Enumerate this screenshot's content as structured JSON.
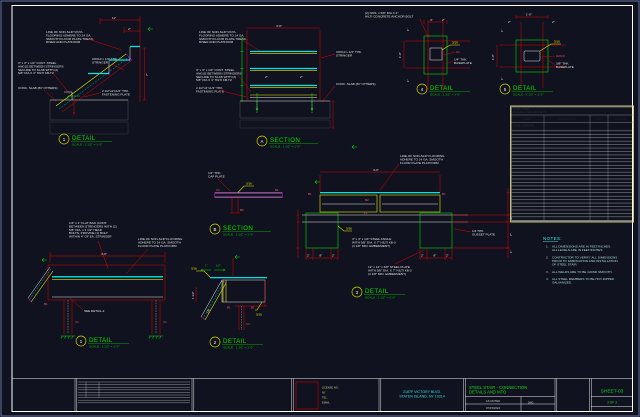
{
  "details": {
    "d1": {
      "title": {
        "num": "1",
        "kind": "DETAIL",
        "scale": "SCALE : 1 1/2\" = 1'-0\""
      },
      "labels": {
        "tread": [
          "LINE OF NON-SLIP VINYL",
          "FLOORING ADHERE TO 14 GA.",
          "SMOOTH FLOOR PLATE TREAD,",
          "RISER AND PLATFORM"
        ],
        "stringer": [
          "C8X10 x 1/4\" THK.",
          "STRINGER"
        ],
        "angle": [
          "3\" x 3\" x 1/4\" CONT. STEEL",
          "ANGLE BETWEEN STRINGERS",
          "SECURE TO SLAB WITH (2)",
          "5/8\" DIA X 4\" HILTI KB-TZ"
        ],
        "slab": "CONC. SLAB (BY OTHERS)",
        "plate": [
          "2 1/2\"x2\"x1/4\" THK.",
          "FASTENING PLATE"
        ]
      },
      "dims": {
        "a": "11\"",
        "b": "2\"",
        "c": "7\""
      }
    },
    "secA": {
      "title": {
        "num": "A",
        "kind": "SECTION",
        "scale": "SCALE : 1 1/2\" = 1'-0\""
      },
      "labels": {
        "tread": [
          "LINE OF NON-SLIP VINYL",
          "FLOORING ADHERE TO 14 GA.",
          "SMOOTH FLOOR PLATE TREAD,",
          "RISER AND PLATFORM"
        ],
        "angle": [
          "3\" x 3\" x 1/4\" CONT. STEEL",
          "ANGLE BETWEEN STRINGERS",
          "SECURE TO SLAB WITH (2)",
          "5/8\" DIA X 4\" HILTI KB-TZ"
        ],
        "plate": [
          "2 1/2\"x2\"x1/4\" THK.",
          "FASTENING PLATE"
        ],
        "stringer": [
          "C8X10 x 1/4\" THK.",
          "STRINGER"
        ],
        "slab": "CONC. SLAB (BY OTHERS)"
      },
      "dims": {
        "w": "4'-0\"",
        "a": "2\"",
        "b": "2\""
      }
    },
    "anchor_note": [
      "(2) NOS. x 5/8\" DIA X 4\"",
      "HILTI CONCRETE ANCHOR BOLT"
    ],
    "d4": {
      "title": {
        "num": "4",
        "kind": "DETAIL",
        "scale": "SCALE : 1 1/2\" = 1'-0\""
      },
      "labels": {
        "weld": "3/16",
        "mark": "C1",
        "plate": [
          "1/4\" THK.",
          "BASEPLATE"
        ]
      },
      "dims": {
        "a": "4\"",
        "b": "2\"",
        "h": "1'-0\"",
        "t1": "1\"",
        "t2": "1\""
      }
    },
    "d5": {
      "title": {
        "num": "5",
        "kind": "DETAIL",
        "scale": "SCALE : 1 1/2\" = 1'-0\""
      },
      "labels": {
        "weld": "3/16",
        "mark": "C2/C3",
        "plate": [
          "3/8\" THK.",
          "BASEPLATE"
        ]
      },
      "dims": {
        "w": "1'-0\"",
        "a": "2\"",
        "b": "2\"",
        "h": "1'-0\"",
        "t1": "1\"",
        "t2": "1\""
      }
    },
    "secB": {
      "title": {
        "num": "B",
        "kind": "SECTION",
        "scale": "SCALE : 1 1/2\" = 1'-0\""
      },
      "labels": {
        "cap": [
          "1/4\" THK.",
          "CAP PLATE"
        ],
        "weld": "3/16",
        "m1": "C1",
        "m2": "B1",
        "m3": "B2"
      }
    },
    "d3": {
      "title": {
        "num": "3",
        "kind": "DETAIL",
        "scale": "SCALE : 1 1/2\" = 1'-0\""
      },
      "labels": {
        "floor": [
          "LINE OF NON-SLIP FLOORING",
          "ADHERE TO 14 GA. SMOOTH",
          "FLOOR PLATE PLATFORM"
        ],
        "angle": [
          "4\" x 4\" x 1/4\" STEEL ANGLE",
          "WITH 5/8\" DIA. X 7\" HILTI KB-3",
          "(4 1/8\" MIN. EMBEDMENT)"
        ],
        "plate": [
          "12\" x 12\" x 3/8\" STEEL PLATE",
          "WITH 5/8\" DIA. X 7\" HILTI KB-3",
          "(4 1/8\" MIN. EMBEDMENT)"
        ],
        "gusset": [
          "1/4 THK.",
          "GUSSET PLATE"
        ],
        "weld": "3/16",
        "m1": "B1",
        "m2": "B1",
        "m3": "B2",
        "m4": "L1"
      },
      "dims": {
        "w": "4'-0\"",
        "s1": "2\"",
        "s2": "8\"",
        "s3": "2\"",
        "s4": "2\"",
        "s5": "8\"",
        "s6": "2\"",
        "r1": "1\"",
        "r2": "7\"",
        "r3": "1\""
      }
    },
    "d1b": {
      "title": {
        "num": "1",
        "kind": "DETAIL",
        "scale": "SCALE : 1 1/2\" = 1'-0\""
      },
      "labels": {
        "flatbar": [
          "1/4\" x 4\" FLAT BAR (CONT.",
          "BETWEEN STRINGERS WITH (2)",
          "5/8\" DIA. x 1 1/2\" HEAD",
          "BOLTS. PROVIDE (1) BOLT",
          "WITHIN 4\" OF EA. STRINGER"
        ],
        "floor": [
          "LINE OF NON-SLIP FLOORING",
          "ADHERE TO 14 GA. SMOOTH",
          "FLOOR PLATE PLATFORM"
        ],
        "see": "SEE DETAIL-2",
        "m1": "B1",
        "m2": "C1",
        "m3": "C1"
      },
      "dims": {
        "w": "4'-0\""
      }
    },
    "d2": {
      "title": {
        "num": "2",
        "kind": "DETAIL",
        "scale": "SCALE : 1 1/2\" = 1'-0\""
      },
      "labels": {
        "weld1": "3/16",
        "weld2": "3/16",
        "m1": "B1",
        "m2": "B1",
        "m3": "C1",
        "m4": "C8"
      },
      "dims": {
        "a": "1\"",
        "b": "1/2\"",
        "c": "1 1/2\""
      }
    }
  },
  "table": {
    "title": [
      "STEEL STAIR",
      "MATERIAL TAKE OFF (MTO)"
    ],
    "headers": [
      "MARK",
      "DESCRIPTION",
      "QTY",
      "LENGTH"
    ],
    "section": "STEEL MEMBERS",
    "row_count": 27
  },
  "notes": {
    "heading": "NOTES:",
    "items": [
      {
        "no": "1.",
        "lines": [
          "ALL DIMENSIONS ARE IN FEET/INCHES.",
          "ALL LEVELS ARE IN FEET/INCHES."
        ]
      },
      {
        "no": "2.",
        "lines": [
          "CONTRACTOR TO VERIFY ALL DIMENSIONS",
          "PRIOR TO FABRICATION AND INSTALLATION",
          "OF STEEL STAIR."
        ]
      },
      {
        "no": "3.",
        "lines": [
          "ALL WELDS ARE TO BE GRIND SMOOTH."
        ]
      },
      {
        "no": "4.",
        "lines": [
          "ALL STEEL MEMBERS TO BE HOT-DIPPED",
          "GALVANIZED."
        ]
      }
    ]
  },
  "titleblock": {
    "stamp_lines": [
      "LICENSE NO :",
      "NY",
      "TEL.",
      "EMAIL"
    ],
    "address": [
      "2187F VICTORY BLVD.",
      "STATEN ISLAND, NY 10314"
    ],
    "project": [
      "STEEL STAIR - CONNECTION",
      "DETAILS AND MTO"
    ],
    "scale_value": "AS NOTED",
    "scale_tag": "DWG.",
    "date_value": "07/15/2024",
    "sheet_no": "SHEET-03",
    "page": "3 OF 3"
  }
}
